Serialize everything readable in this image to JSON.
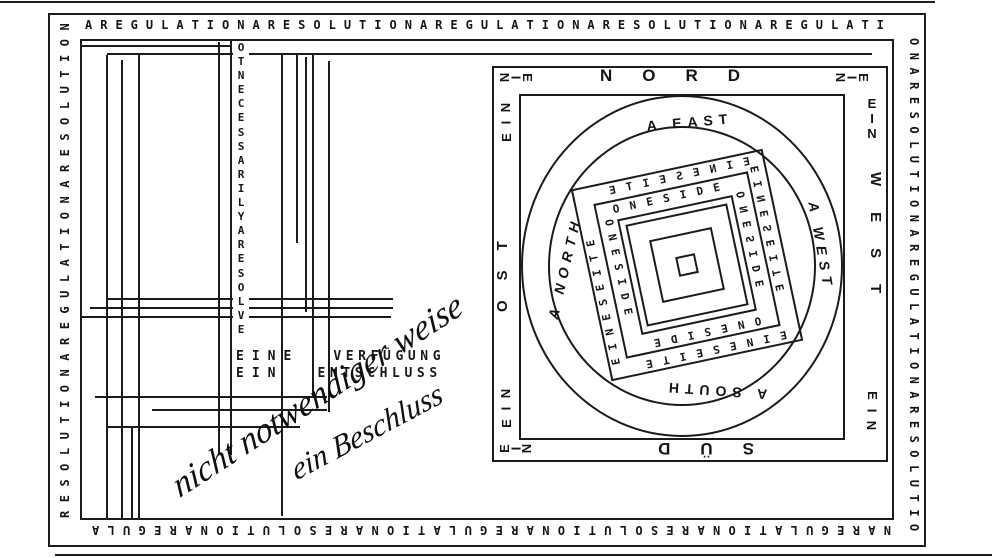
{
  "artwork": {
    "colors": {
      "ink": "#1b1b1b",
      "paper": "#ffffff"
    },
    "border": {
      "top": "AREGULATIONARESOLUTIONAREGULATIONARESOLUTIONAREGULATI",
      "right": "ONARESOLUTIONAREGULATIONARESOLUTIO",
      "bottom": "NAREGULATIONARESOLUTIONAREGULATIONARESOLUTIONAREGULA",
      "left": "RESOLUTIONAREGULATIONARESOLUTION"
    },
    "left_panel": {
      "vertical_column": "OTNECESSARILYARESOLVE",
      "rows": [
        [
          "EINE",
          "VERFÜGUNG"
        ],
        [
          "EIN",
          "ENTSCHLUSS"
        ]
      ],
      "handwriting": {
        "line1": "nicht notwendiger weise",
        "line2": "ein Beschluss"
      }
    },
    "compass": {
      "frame": {
        "top": "NORD",
        "right": "WEST",
        "bottom": "SÜD",
        "left": "OST",
        "corner_word": "EIN"
      },
      "ring": {
        "top": "A EAST",
        "right": "A WEST",
        "bottom": "A SOUTH",
        "left": "A NORTH"
      },
      "outer_band_word": "EINESEITE",
      "inner_band_word": "ONESIDE"
    }
  }
}
